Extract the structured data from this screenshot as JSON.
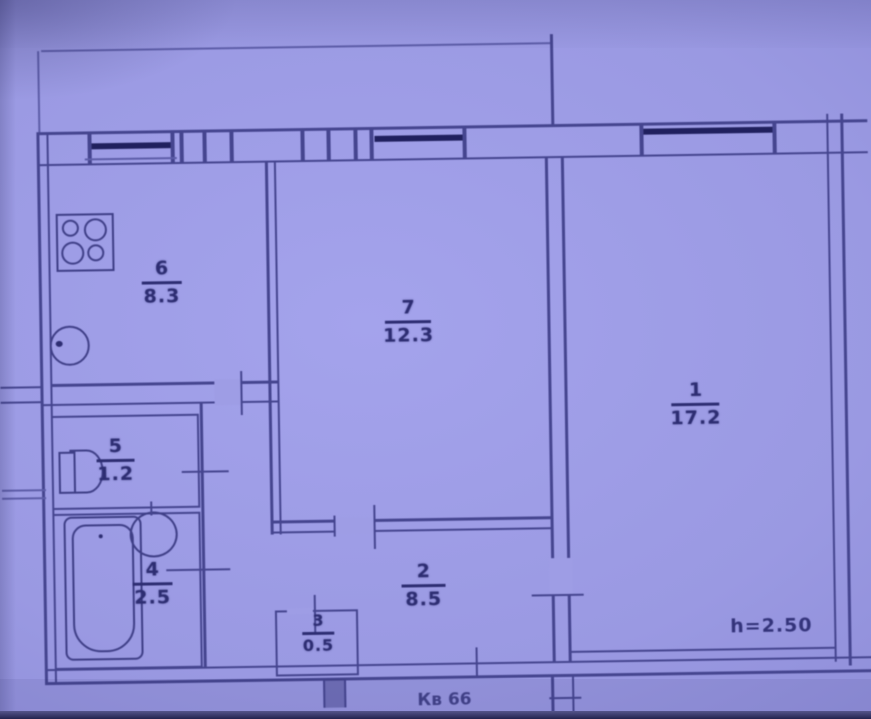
{
  "document": {
    "type": "apartment-floor-plan-photo",
    "tint": "blue-purple"
  },
  "rooms": [
    {
      "number": "1",
      "area": "17.2",
      "kind": "living-room"
    },
    {
      "number": "2",
      "area": "8.5",
      "kind": "hallway"
    },
    {
      "number": "3",
      "area": "0.5",
      "kind": "closet"
    },
    {
      "number": "4",
      "area": "2.5",
      "kind": "bathroom"
    },
    {
      "number": "5",
      "area": "1.2",
      "kind": "wc"
    },
    {
      "number": "6",
      "area": "8.3",
      "kind": "kitchen"
    },
    {
      "number": "7",
      "area": "12.3",
      "kind": "room"
    }
  ],
  "annotations": {
    "ceiling_height": "h=2.50",
    "apartment_number": "Кв 66"
  },
  "fixtures": [
    "stove-icon",
    "sink-icon",
    "toilet-icon",
    "washbasin-icon",
    "bathtub-icon"
  ],
  "colors": {
    "paper": "#9b9ae3",
    "wall_line": "#45458f",
    "ink": "#2d2d72",
    "window_glazing": "#20205e"
  }
}
